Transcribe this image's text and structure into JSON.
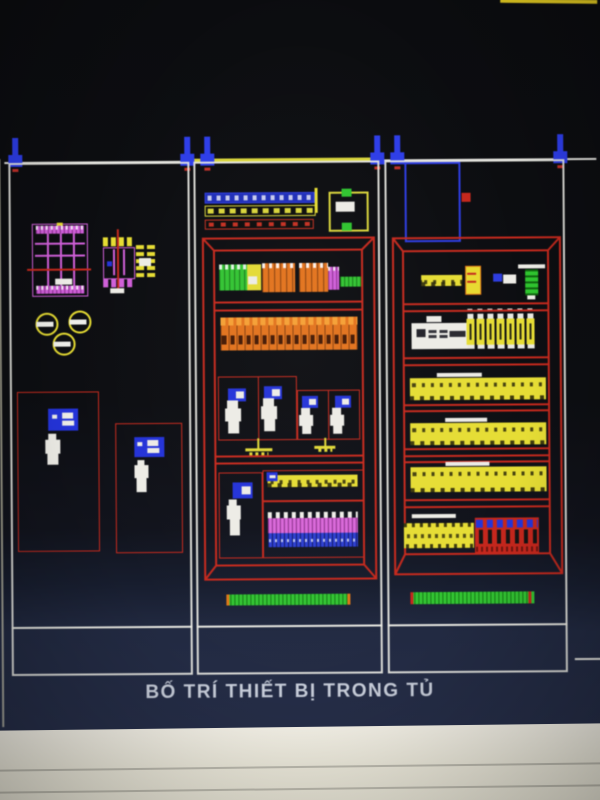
{
  "title_block": {
    "text": "BỐ TRÍ THIẾT BỊ TRONG TỦ"
  },
  "colors": {
    "line_white": "#e3e3de",
    "cad_red": "#c5291d",
    "cad_yellow": "#e6dc33",
    "cad_blue": "#2433d8",
    "cad_green": "#33c433",
    "cad_orange": "#e2731d",
    "cad_magenta": "#cf5fd8",
    "screen_navy": "#252d47",
    "bezel_cream": "#ece9dd",
    "title_text": "#c6ccd8"
  },
  "cabinets": {
    "left_panel": {
      "components": [
        "mccb-3pole-elevation",
        "contactor-elevation",
        "aux-contact-block",
        "pilot-lamp",
        "pilot-lamp",
        "pilot-lamp",
        "breaker-bay-large",
        "breaker-bay-small"
      ]
    },
    "middle_panel": {
      "components": [
        "din-rail-blue",
        "din-rail-yellow",
        "din-rail-red",
        "door-mounted-device",
        "terminal-group-green",
        "relay-yellow",
        "terminal-group-orange-1",
        "terminal-group-orange-2",
        "terminal-magenta",
        "neutral-bar-green",
        "terminal-strip-row",
        "contactor-cell-1",
        "contactor-cell-2",
        "contactor-cell-3",
        "contactor-cell-4",
        "earth-symbol",
        "earth-symbol",
        "contactor-cell-5",
        "busbar-yellow",
        "terminal-bank-pink-blue",
        "plinth-bar-green"
      ]
    },
    "right_panel": {
      "components": [
        "door-frame-blue",
        "marker-red",
        "busbar-stub-yellow",
        "capacitor",
        "indicator-pair",
        "sensor-green",
        "controller-white",
        "fuse-bank-7",
        "busbar-row-1",
        "busbar-row-2",
        "busbar-row-3",
        "terminal-strip-yellow",
        "terminal-blocks-red-blue",
        "plinth-bar-green"
      ]
    }
  }
}
